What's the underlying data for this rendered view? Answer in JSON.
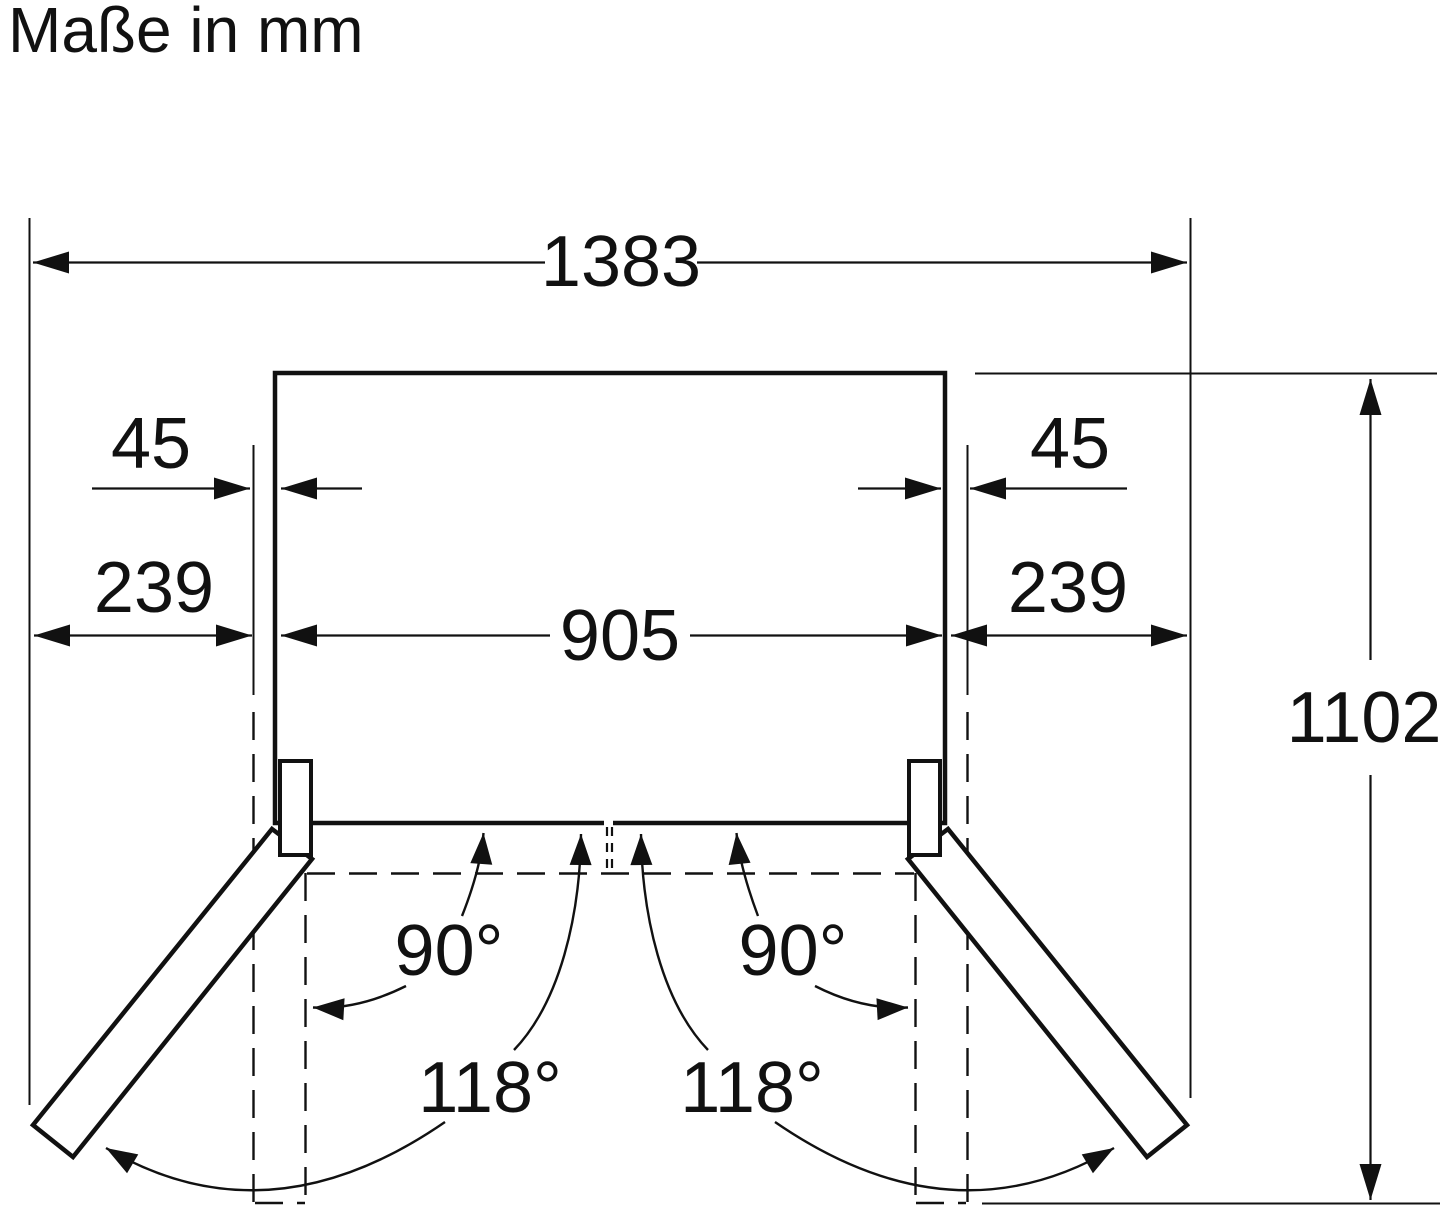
{
  "title": "Maße in mm",
  "dims": {
    "overall_width": "1383",
    "left_clearance": "45",
    "right_clearance": "45",
    "left_overhang": "239",
    "right_overhang": "239",
    "body_width": "905",
    "depth_doors_open": "1102"
  },
  "angles": {
    "left_open_90": "90°",
    "left_open_118": "118°",
    "right_open_90": "90°",
    "right_open_118": "118°"
  },
  "colors": {
    "ink": "#111111",
    "background": "#ffffff"
  }
}
